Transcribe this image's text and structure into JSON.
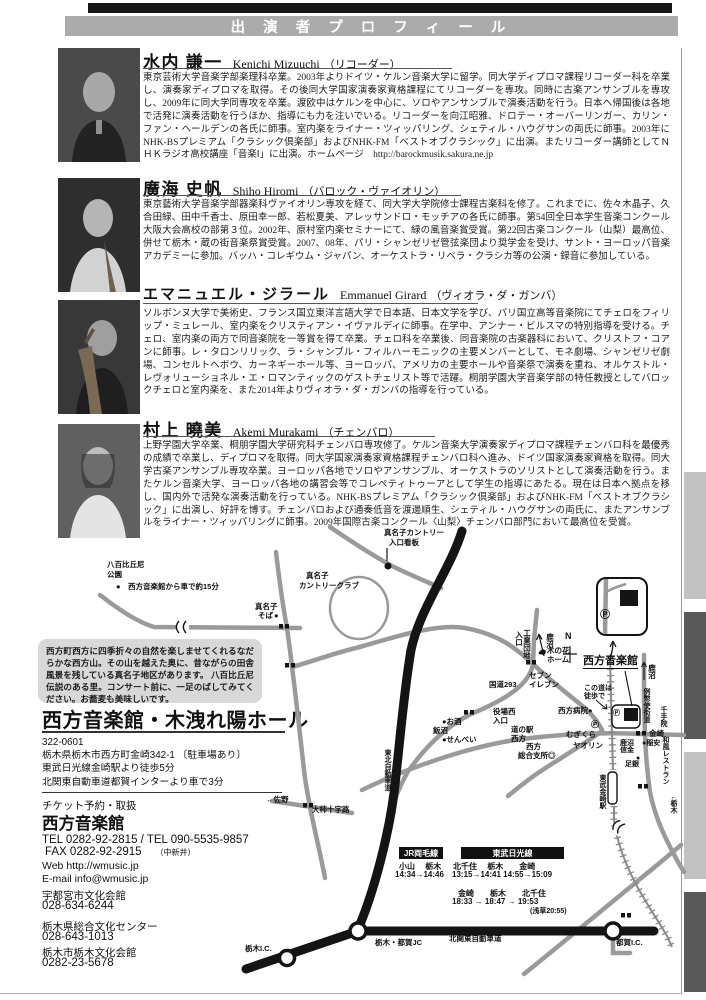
{
  "header": {
    "title": "出 演 者 プ ロ フ ィ ー ル"
  },
  "performers": [
    {
      "name_ja": "水内 謙一",
      "name_en": "Kenichi Mizuuchi",
      "instrument": "（リコーダー）",
      "bio": "東京芸術大学音楽学部楽理科卒業。2003年よりドイツ・ケルン音楽大学に留学。同大学ディプロマ課程リコーダー科を卒業し、演奏家ディプロマを取得。その後同大学国家演奏家資格課程にてリコーダーを専攻。同時に古楽アンサンブルを専攻し、2009年に同大学同専攻を卒業。渡欧中はケルンを中心に、ソロやアンサンブルで演奏活動を行う。日本へ帰国後は各地で活発に演奏活動を行うほか、指導にも力を注いでいる。リコーダーを向江昭雅、ドロテー・オーバーリンガー、カリン・ファン・ヘールデンの各氏に師事。室内楽をライナー・ツィッパリング、シェティル・ハウグサンの両氏に師事。2003年にNHK-BSプレミアム「クラシック倶楽部」およびNHK-FM「ベストオブクラシック」に出演。またリコーダー講師としてＮＨＫラジオ高校講座「音楽Ⅰ」に出演。ホームページ　http://barockmusik.sakura.ne.jp"
    },
    {
      "name_ja": "廣海 史帆",
      "name_en": "Shiho Hiromi",
      "instrument": "（バロック・ヴァイオリン）",
      "bio": "東京藝術大学音楽学部器楽科ヴァイオリン専攻を経て、同大学大学院修士課程古楽科を修了。これまでに、佐々木晶子、久合田緑、田中千香士、原田幸一郎、若松夏美、アレッサンドロ・モッチアの各氏に師事。第54回全日本学生音楽コンクール大阪大会高校の部第３位。2002年、原村室内楽セミナーにて、緑の風音楽賞受賞。第22回古楽コンクール（山梨）最高位、併せて栃木・蔵の街音楽祭賞受賞。2007、08年、パリ・シャンゼリゼ管弦楽団より奨学金を受け、サント・ヨーロッパ音楽アカデミーに参加。バッハ・コレギウム・ジャパン、オーケストラ・リベラ・クラシカ等の公演・録音に参加している。"
    },
    {
      "name_ja": "エマニュエル・ジラール",
      "name_en": "Emmanuel Girard",
      "instrument": "（ヴィオラ・ダ・ガンバ）",
      "bio": "ソルボンヌ大学で美術史、フランス国立東洋言語大学で日本語、日本文学を学び、パリ国立高等音楽院にてチェロをフィリップ・ミュレール、室内楽をクリスティアン・イヴァルディに師事。在学中、アンナー・ビルスマの特別指導を受ける。チェロ、室内楽の両方で同音楽院を一等賞を得て卒業。チェロ科を卒業後、同音楽院の古楽器科において、クリストフ・コアンに師事。レ・タロンリリック、ラ・シャンブル・フィルハーモニックの主要メンバーとして、モネ劇場、シャンゼリゼ劇場、コンセルトヘボウ、カーネギーホール等、ヨーロッパ、アメリカの主要ホールや音楽祭で演奏を重ね、オルケストル・レヴォリューショネル・エ・ロマンティックのゲストチェリスト等で活躍。桐朋学園大学音楽学部の特任教授としてバロックチェロと室内楽を、また2014年よりヴィオラ・ダ・ガンバの指導を行っている。"
    },
    {
      "name_ja": "村上 曉美",
      "name_en": "Akemi Murakami",
      "instrument": "（チェンバロ）",
      "bio": "上野学園大学卒業、桐朋学園大学研究科チェンバロ専攻修了。ケルン音楽大学演奏家ディプロマ課程チェンバロ科を最優秀の成績で卒業し、ディプロマを取得。同大学国家演奏家資格課程チェンバロ科へ進み、ドイツ国家演奏家資格を取得。同大学古楽アンサンブル専攻卒業。ヨーロッパ各地でソロやアンサンブル、オーケストラのソリストとして演奏活動を行う。またケルン音楽大学、ヨーロッパ各地の講習会等でコレペティトゥーアとして学生の指導にあたる。現在は日本へ拠点を移し、国内外で活発な演奏活動を行っている。NHK-BSプレミアム「クラシック倶楽部」およびNHK-FM「ベストオブクラシック」に出演し、好評を博す。チェンバロおよび通奏低音を渡邊順生、シェティル・ハウグサンの両氏に、またアンサンブルをライナー・ツィッパリングに師事。2009年国際古楽コンクール〈山梨〉チェンバロ部門において最高位を受賞。"
    }
  ],
  "note_box": {
    "text": "西方町西方に四季折々の自然を楽しませてくれるなだらかな西方山。その山を越えた奥に、昔ながらの田舎風景を残している真名子地区があります。 八百比丘尼伝説のある里。コンサート前に、一足のばしてみてください。お蕎麦も美味しいです。"
  },
  "venue": {
    "title": "西方音楽館・木洩れ陽ホール",
    "postal": "322-0601",
    "address": "栃木県栃木市西方町金崎342-1 〔駐車場あり〕",
    "access1": "東武日光線金崎駅より徒歩5分",
    "access2": "北関東自動車道都賀インターより車で3分"
  },
  "tickets": {
    "heading": "チケット予約・取扱",
    "name": "西方音楽館",
    "tel": "TEL 0282-92-2815 / TEL 090-5535-9857",
    "fax": "FAX 0282-92-2915",
    "fax_note": "（中新井）",
    "web": "Web  http://wmusic.jp",
    "email": "E-mail  info@wmusic.jp",
    "outlets": [
      {
        "name": "宇都宮市文化会館",
        "tel": "028-634-6244"
      },
      {
        "name": "栃木県総合文化センター",
        "tel": "028-643-1013"
      },
      {
        "name": "栃木市栃木文化会館",
        "tel": "0282-23-5678"
      }
    ]
  },
  "map": {
    "schedule": {
      "jr_title": "JR両毛線",
      "jr_stations": "小山　 栃木",
      "jr_times": "14:34→14:46",
      "tobu_title": "東武日光線",
      "tobu_row1_stations": "北千住　 栃木　　金崎",
      "tobu_row1_times": "13:15→14:41 14:55→15:09",
      "tobu_row2_stations": "金崎　　栃木　　北千住",
      "tobu_row2_times": "18:33 →  18:47  →  19:53",
      "tobu_row2_note": "(浅草20:55)"
    },
    "labels": [
      {
        "t": "真名子カントリー",
        "x": 384,
        "y": 529
      },
      {
        "t": "入口看板",
        "x": 389,
        "y": 539
      },
      {
        "t": "八百比丘尼",
        "x": 107,
        "y": 561
      },
      {
        "t": "公園",
        "x": 107,
        "y": 571
      },
      {
        "t": "●",
        "x": 116,
        "y": 583
      },
      {
        "t": "西方音楽館から車で約15分",
        "x": 128,
        "y": 583
      },
      {
        "t": "真名子",
        "x": 306,
        "y": 572
      },
      {
        "t": "カントリークラブ",
        "x": 299,
        "y": 582
      },
      {
        "t": "真名子",
        "x": 255,
        "y": 603
      },
      {
        "t": "そば",
        "x": 258,
        "y": 612
      },
      {
        "t": "●",
        "x": 274,
        "y": 612
      },
      {
        "t": "工業団地",
        "x": 523,
        "y": 629,
        "v": 1
      },
      {
        "t": "入口",
        "x": 515,
        "y": 631,
        "v": 1
      },
      {
        "t": "鹿沼",
        "x": 546,
        "y": 633,
        "v": 1
      },
      {
        "t": "N",
        "x": 565,
        "y": 632,
        "s": 9
      },
      {
        "t": "●",
        "x": 538,
        "y": 649
      },
      {
        "t": "木の花",
        "x": 547,
        "y": 647
      },
      {
        "t": "ホーム",
        "x": 547,
        "y": 656
      },
      {
        "t": "セブン",
        "x": 529,
        "y": 672
      },
      {
        "t": "イレブン",
        "x": 529,
        "y": 681
      },
      {
        "t": "国道293",
        "x": 489,
        "y": 681
      },
      {
        "t": "西方音楽館",
        "x": 583,
        "y": 656,
        "s": 11,
        "u": 1
      },
      {
        "t": "鹿沼",
        "x": 648,
        "y": 664,
        "v": 1
      },
      {
        "t": "この道は",
        "x": 584,
        "y": 685,
        "s": 7
      },
      {
        "t": "徒歩で",
        "x": 584,
        "y": 693,
        "s": 7
      },
      {
        "t": "西方病院●",
        "x": 558,
        "y": 707
      },
      {
        "t": "役場西",
        "x": 493,
        "y": 708
      },
      {
        "t": "入口",
        "x": 493,
        "y": 717
      },
      {
        "t": "道の駅",
        "x": 511,
        "y": 726
      },
      {
        "t": "西方",
        "x": 511,
        "y": 735
      },
      {
        "t": "●お酒",
        "x": 442,
        "y": 718
      },
      {
        "t": "飯沼",
        "x": 433,
        "y": 727
      },
      {
        "t": "●せんべい",
        "x": 442,
        "y": 736
      },
      {
        "t": "西方",
        "x": 526,
        "y": 743
      },
      {
        "t": "総合支所◎",
        "x": 518,
        "y": 752
      },
      {
        "t": "Ⓟ",
        "x": 591,
        "y": 721,
        "s": 8
      },
      {
        "t": "むぎくら",
        "x": 566,
        "y": 731
      },
      {
        "t": "ヤオリン",
        "x": 573,
        "y": 742
      },
      {
        "t": "東北自動車道",
        "x": 384,
        "y": 749,
        "v": 1,
        "s": 7
      },
      {
        "t": "例幣使街道",
        "x": 643,
        "y": 688,
        "v": 1,
        "s": 7
      },
      {
        "t": "千手院",
        "x": 660,
        "y": 706,
        "v": 1,
        "s": 7
      },
      {
        "t": "金崎",
        "x": 649,
        "y": 730
      },
      {
        "t": "鹿沼",
        "x": 620,
        "y": 740,
        "s": 7
      },
      {
        "t": "信金",
        "x": 620,
        "y": 747,
        "s": 7
      },
      {
        "t": "●稲安",
        "x": 642,
        "y": 740,
        "s": 7
      },
      {
        "t": "和風レストラン",
        "x": 662,
        "y": 736,
        "v": 1,
        "s": 7
      },
      {
        "t": "●",
        "x": 636,
        "y": 755,
        "s": 7
      },
      {
        "t": "足銀",
        "x": 625,
        "y": 761,
        "s": 7
      },
      {
        "t": "東武金崎駅",
        "x": 599,
        "y": 774,
        "v": 1,
        "s": 7
      },
      {
        "t": "↓栃木",
        "x": 670,
        "y": 796,
        "v": 1,
        "s": 7
      },
      {
        "t": "←佐野",
        "x": 266,
        "y": 796
      },
      {
        "t": "大柿十字路",
        "x": 312,
        "y": 806
      },
      {
        "t": "栃木I.C.",
        "x": 245,
        "y": 945
      },
      {
        "t": "栃木・都賀JC",
        "x": 375,
        "y": 939
      },
      {
        "t": "北関東自動車道",
        "x": 449,
        "y": 935
      },
      {
        "t": "都賀I.C.",
        "x": 616,
        "y": 939
      },
      {
        "t": "Ⓟ",
        "x": 600,
        "y": 611,
        "s": 10
      },
      {
        "t": "Ⓟ",
        "x": 613,
        "y": 710,
        "s": 7
      }
    ]
  }
}
